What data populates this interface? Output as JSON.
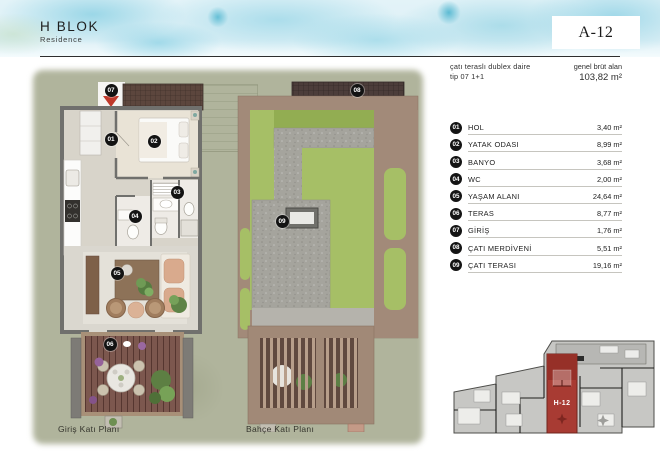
{
  "header": {
    "block_title": "H BLOK",
    "block_subtitle": "Residence",
    "unit_code": "A-12",
    "type_line1": "çatı teraslı dublex daire",
    "type_line2": "tip 07 1+1",
    "gross_area_label": "genel brüt alan",
    "gross_area_value": "103,82 m²"
  },
  "legend": {
    "rooms": [
      {
        "no": "01",
        "name": "HOL",
        "area": "3,40 m²"
      },
      {
        "no": "02",
        "name": "YATAK ODASI",
        "area": "8,99 m²"
      },
      {
        "no": "03",
        "name": "BANYO",
        "area": "3,68 m²"
      },
      {
        "no": "04",
        "name": "WC",
        "area": "2,00 m²"
      },
      {
        "no": "05",
        "name": "YAŞAM ALANI",
        "area": "24,64 m²"
      },
      {
        "no": "06",
        "name": "TERAS",
        "area": "8,77 m²"
      },
      {
        "no": "07",
        "name": "GİRİŞ",
        "area": "1,76 m²"
      },
      {
        "no": "08",
        "name": "ÇATI MERDİVENİ",
        "area": "5,51 m²"
      },
      {
        "no": "09",
        "name": "ÇATI TERASI",
        "area": "19,16 m²"
      }
    ]
  },
  "plans": {
    "ground_label": "Giriş Katı Planı",
    "garden_label": "Bahçe Katı Planı"
  },
  "site_plan": {
    "highlight_label": "H-12"
  },
  "colors": {
    "accent_red": "#c0392b",
    "highlight_unit": "#a83b33",
    "marker_bg": "#141414",
    "grass": "#b0b49c",
    "watercolor_blue": "#a9dcec"
  }
}
